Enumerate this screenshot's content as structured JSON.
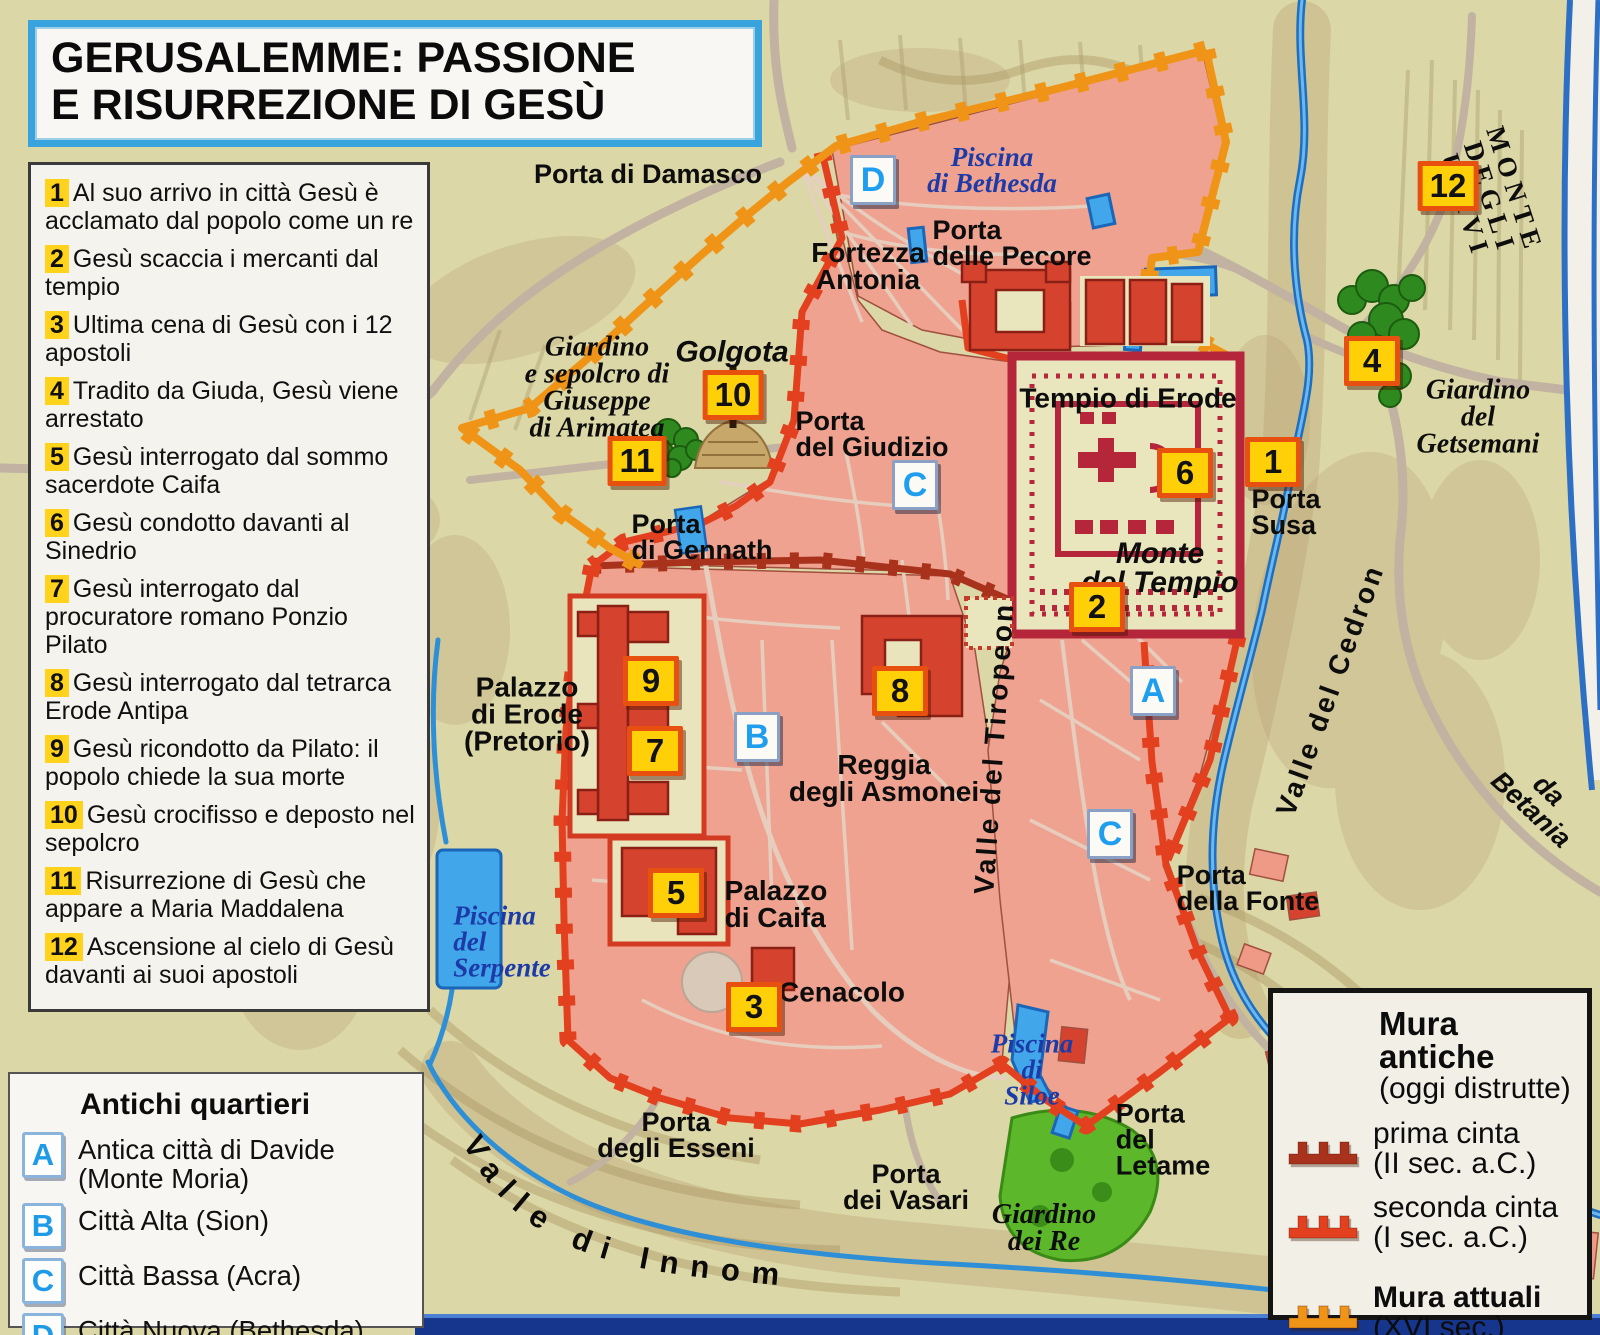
{
  "title": {
    "line1": "GERUSALEMME: PASSIONE",
    "line2": "E RISURREZIONE DI GESÙ"
  },
  "events": [
    {
      "num": "1",
      "text": "Al suo arrivo in città Gesù è acclamato dal popolo come un re"
    },
    {
      "num": "2",
      "text": "Gesù scaccia i mercanti dal tempio"
    },
    {
      "num": "3",
      "text": "Ultima cena di Gesù con i 12 apostoli"
    },
    {
      "num": "4",
      "text": "Tradito da Giuda, Gesù viene arrestato"
    },
    {
      "num": "5",
      "text": "Gesù interrogato dal sommo sacerdote Caifa"
    },
    {
      "num": "6",
      "text": "Gesù condotto davanti al Sinedrio"
    },
    {
      "num": "7",
      "text": "Gesù interrogato dal procuratore romano Ponzio Pilato"
    },
    {
      "num": "8",
      "text": "Gesù interrogato dal tetrarca Erode Antipa"
    },
    {
      "num": "9",
      "text": "Gesù ricondotto da Pilato: il popolo chiede la sua morte"
    },
    {
      "num": "10",
      "text": "Gesù crocifisso e deposto nel sepolcro"
    },
    {
      "num": "11",
      "text": "Risurrezione di Gesù che appare a Maria Maddalena"
    },
    {
      "num": "12",
      "text": "Ascensione al cielo di Gesù davanti ai suoi apostoli"
    }
  ],
  "quarters": {
    "heading": "Antichi quartieri",
    "items": [
      {
        "letter": "A",
        "label": "Antica città di Davide (Monte Moria)"
      },
      {
        "letter": "B",
        "label": "Città Alta (Sion)"
      },
      {
        "letter": "C",
        "label": "Città Bassa (Acra)"
      },
      {
        "letter": "D",
        "label": "Città Nuova (Bethesda)"
      }
    ]
  },
  "walls_legend": {
    "heading": "Mura antiche",
    "subheading": "(oggi distrutte)",
    "items": [
      {
        "label": "prima cinta",
        "detail": "(II sec. a.C.)",
        "color": "#a8321c"
      },
      {
        "label": "seconda cinta",
        "detail": "(I sec. a.C.)",
        "color": "#e2401f"
      },
      {
        "label": "Mura attuali",
        "detail": "(XVI sec.)",
        "color": "#ef9416",
        "bold": true,
        "gap": true
      }
    ]
  },
  "map": {
    "curved_label": "Valle di Innom",
    "labels": [
      {
        "text": "Porta di Damasco",
        "x": 648,
        "y": 174,
        "cls": "porta"
      },
      {
        "text": "Piscina\ndi Bethesda",
        "x": 992,
        "y": 170,
        "cls": "water"
      },
      {
        "text": "Porta\ndelle Pecore",
        "x": 1012,
        "y": 243,
        "cls": "porta",
        "align": "l"
      },
      {
        "text": "Fortezza\nAntonia",
        "x": 868,
        "y": 266,
        "cls": "place"
      },
      {
        "text": "Giardino\ne sepolcro di\nGiuseppe\ndi Arimatea",
        "x": 597,
        "y": 388,
        "cls": "garden"
      },
      {
        "text": "Golgota",
        "x": 732,
        "y": 352,
        "cls": "place-it"
      },
      {
        "text": "Porta\ndel Giudizio",
        "x": 872,
        "y": 434,
        "cls": "porta",
        "align": "l"
      },
      {
        "text": "Porta\ndi Gennath",
        "x": 702,
        "y": 537,
        "cls": "porta",
        "align": "l"
      },
      {
        "text": "Tempio di Erode",
        "x": 1128,
        "y": 398,
        "cls": "place"
      },
      {
        "text": "Monte\ndel Tempio",
        "x": 1160,
        "y": 568,
        "cls": "place-it"
      },
      {
        "text": "Porta\nSusa",
        "x": 1286,
        "y": 512,
        "cls": "porta",
        "align": "l"
      },
      {
        "text": "Giardino del\nGetsemani",
        "x": 1478,
        "y": 417,
        "cls": "garden"
      },
      {
        "text": "MONTE DEGLI ULIVI",
        "x": 1490,
        "y": 198,
        "rot": 72,
        "cls": "ridge"
      },
      {
        "text": "Valle del Cedron",
        "x": 1330,
        "y": 690,
        "rot": -70,
        "cls": "valley"
      },
      {
        "text": "da Betania",
        "x": 1540,
        "y": 800,
        "rot": 43,
        "cls": "roadlbl"
      },
      {
        "text": "Valle del Tiropeon",
        "x": 994,
        "y": 748,
        "rot": -86,
        "cls": "valley"
      },
      {
        "text": "Palazzo\ndi Erode\n(Pretorio)",
        "x": 527,
        "y": 714,
        "cls": "place"
      },
      {
        "text": "Reggia\ndegli Asmonei",
        "x": 884,
        "y": 778,
        "cls": "place"
      },
      {
        "text": "Palazzo\ndi Caifa",
        "x": 776,
        "y": 904,
        "cls": "place",
        "align": "l"
      },
      {
        "text": "Cenacolo",
        "x": 842,
        "y": 992,
        "cls": "place"
      },
      {
        "text": "Piscina\ndel\nSerpente",
        "x": 502,
        "y": 942,
        "cls": "water",
        "align": "l"
      },
      {
        "text": "Piscina\ndi\nSiloe",
        "x": 1032,
        "y": 1070,
        "cls": "water"
      },
      {
        "text": "Porta\ndegli Esseni",
        "x": 676,
        "y": 1135,
        "cls": "porta"
      },
      {
        "text": "Porta\ndei Vasari",
        "x": 906,
        "y": 1187,
        "cls": "porta"
      },
      {
        "text": "Giardino\ndei Re",
        "x": 1044,
        "y": 1228,
        "cls": "garden"
      },
      {
        "text": "Porta\ndel\nLetame",
        "x": 1163,
        "y": 1140,
        "cls": "porta",
        "align": "l"
      },
      {
        "text": "Porta\ndella Fonte",
        "x": 1248,
        "y": 888,
        "cls": "porta",
        "align": "l"
      }
    ],
    "markers_numbered": [
      {
        "num": "1",
        "x": 1273,
        "y": 462
      },
      {
        "num": "2",
        "x": 1097,
        "y": 607
      },
      {
        "num": "3",
        "x": 754,
        "y": 1007
      },
      {
        "num": "4",
        "x": 1372,
        "y": 361
      },
      {
        "num": "5",
        "x": 676,
        "y": 893
      },
      {
        "num": "6",
        "x": 1185,
        "y": 473
      },
      {
        "num": "7",
        "x": 655,
        "y": 751
      },
      {
        "num": "8",
        "x": 900,
        "y": 691
      },
      {
        "num": "9",
        "x": 651,
        "y": 681
      },
      {
        "num": "10",
        "x": 733,
        "y": 395
      },
      {
        "num": "11",
        "x": 637,
        "y": 461
      },
      {
        "num": "12",
        "x": 1448,
        "y": 186
      }
    ],
    "markers_letters": [
      {
        "letter": "A",
        "x": 1153,
        "y": 691
      },
      {
        "letter": "B",
        "x": 757,
        "y": 737
      },
      {
        "letter": "C",
        "x": 915,
        "y": 485
      },
      {
        "letter": "C",
        "x": 1110,
        "y": 834
      },
      {
        "letter": "D",
        "x": 873,
        "y": 180
      }
    ]
  }
}
